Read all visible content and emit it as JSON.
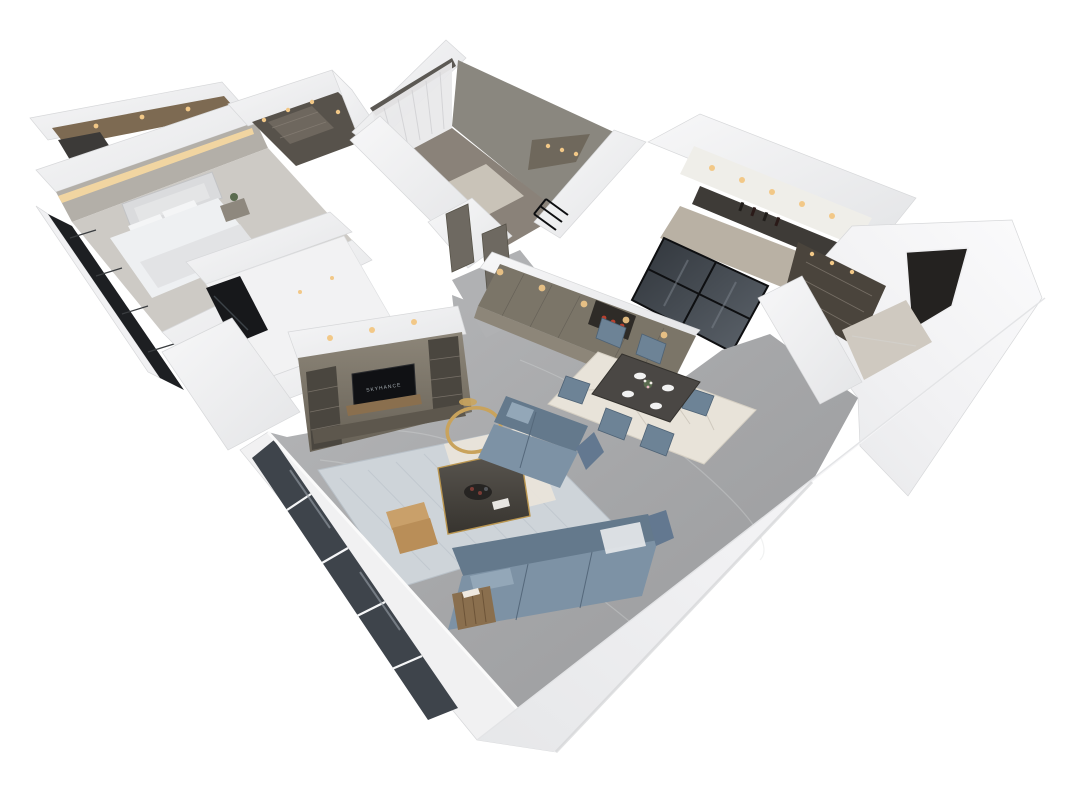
{
  "scene": {
    "type": "3d-apartment-floorplan-render",
    "view": "isometric-dollhouse-top-down",
    "background": "#ffffff"
  },
  "palette": {
    "wall_white": "#f2f2f4",
    "wall_shadow": "#d8d9db",
    "floor_marble_gray": "#a8a9ab",
    "bedroom_carpet": "#cdcac5",
    "cabinet_taupe": "#7b7568",
    "cabinet_dark": "#4a463f",
    "glass_dark": "#3e444b",
    "window_black": "#1d1f22",
    "sofa_blue": "#7d92a5",
    "sofa_blue_dark": "#64798c",
    "chair_blue": "#6d8396",
    "rug_living": "#ced4d9",
    "rug_dining": "#e8e3d9",
    "dining_table_dark": "#4a4744",
    "wood_warm": "#8a6f4e",
    "leather_tan": "#c9a06a",
    "gold_accent": "#c9a35c",
    "warm_light": "#f2c887",
    "bed_white": "#eef0f2",
    "headboard_gray": "#dadbdd",
    "plant_green": "#5a6b4f",
    "decor_red": "#b8402e"
  },
  "rooms": {
    "master_bedroom": {
      "label": "master-bedroom",
      "items": [
        "double-bed",
        "tufted-headboard",
        "pillows",
        "nightstand",
        "plant",
        "cove-lighting",
        "dark-window-wall",
        "dressing-corridor"
      ]
    },
    "walk_in_closet": {
      "label": "walk-in-closet",
      "items": [
        "open-shelving",
        "ceiling-spotlights"
      ]
    },
    "bedroom_two": {
      "label": "second-bedroom",
      "items": [
        "sheer-curtains",
        "lit-wardrobe",
        "floor-mat",
        "black-railing"
      ]
    },
    "study": {
      "label": "study-room",
      "items": [
        "glossy-white-floor",
        "dark-window"
      ]
    },
    "kitchen": {
      "label": "kitchen",
      "items": [
        "upper-cabinets",
        "dark-counter",
        "wine-bottles",
        "black-frame-glass-doors",
        "ceiling-spotlights"
      ]
    },
    "entry_hall": {
      "label": "entry-hall",
      "items": [
        "bronze-display-cabinet",
        "dark-entry-door",
        "marble-floor"
      ]
    },
    "dining_room": {
      "label": "dining-room",
      "chairs": 6,
      "plates": 4,
      "items": [
        "stone-top-table",
        "six-upholstered-chairs",
        "place-settings",
        "flower-centerpiece",
        "cream-geometric-rug",
        "taupe-cabinet-wall",
        "display-niche",
        "spotlights"
      ]
    },
    "living_room": {
      "label": "living-room",
      "tv_screen_text": "SKYHANCE",
      "items": [
        "l-shaped-blue-sofa",
        "marble-coffee-table",
        "gold-round-mirror",
        "tan-armchair",
        "wood-side-table",
        "tv-media-wall",
        "patterned-blue-rug",
        "floor-to-ceiling-windows"
      ]
    }
  }
}
